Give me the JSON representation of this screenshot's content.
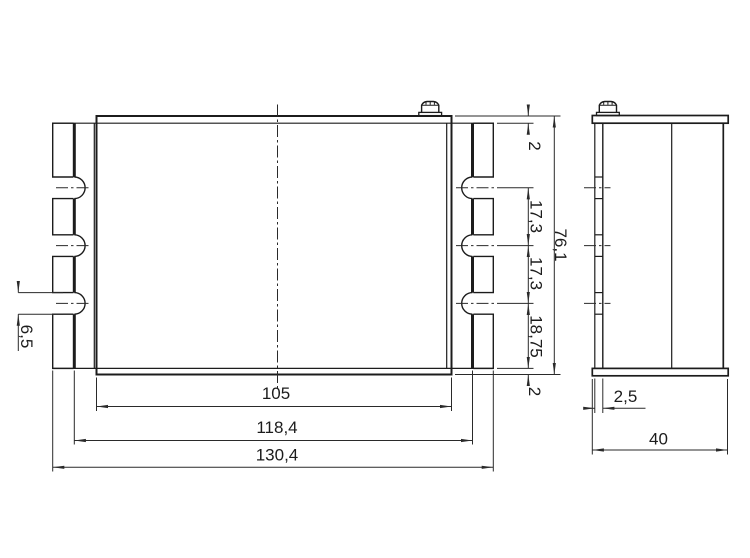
{
  "drawing": {
    "type": "technical-dimension-drawing",
    "units": "mm",
    "colors": {
      "line": "#1c1c1c",
      "dimension": "#2a2a2a",
      "background": "#ffffff"
    },
    "dims": {
      "wall_top": "2",
      "slot_pitch_1": "17,3",
      "slot_pitch_2": "17,3",
      "slot_to_bottom": "18,75",
      "wall_bottom": "2",
      "overall_height": "76,1",
      "slot_width": "6,5",
      "body_width": "105",
      "slot_spacing": "118,4",
      "overall_width": "130,4",
      "plate_thickness": "2,5",
      "depth": "40"
    }
  }
}
